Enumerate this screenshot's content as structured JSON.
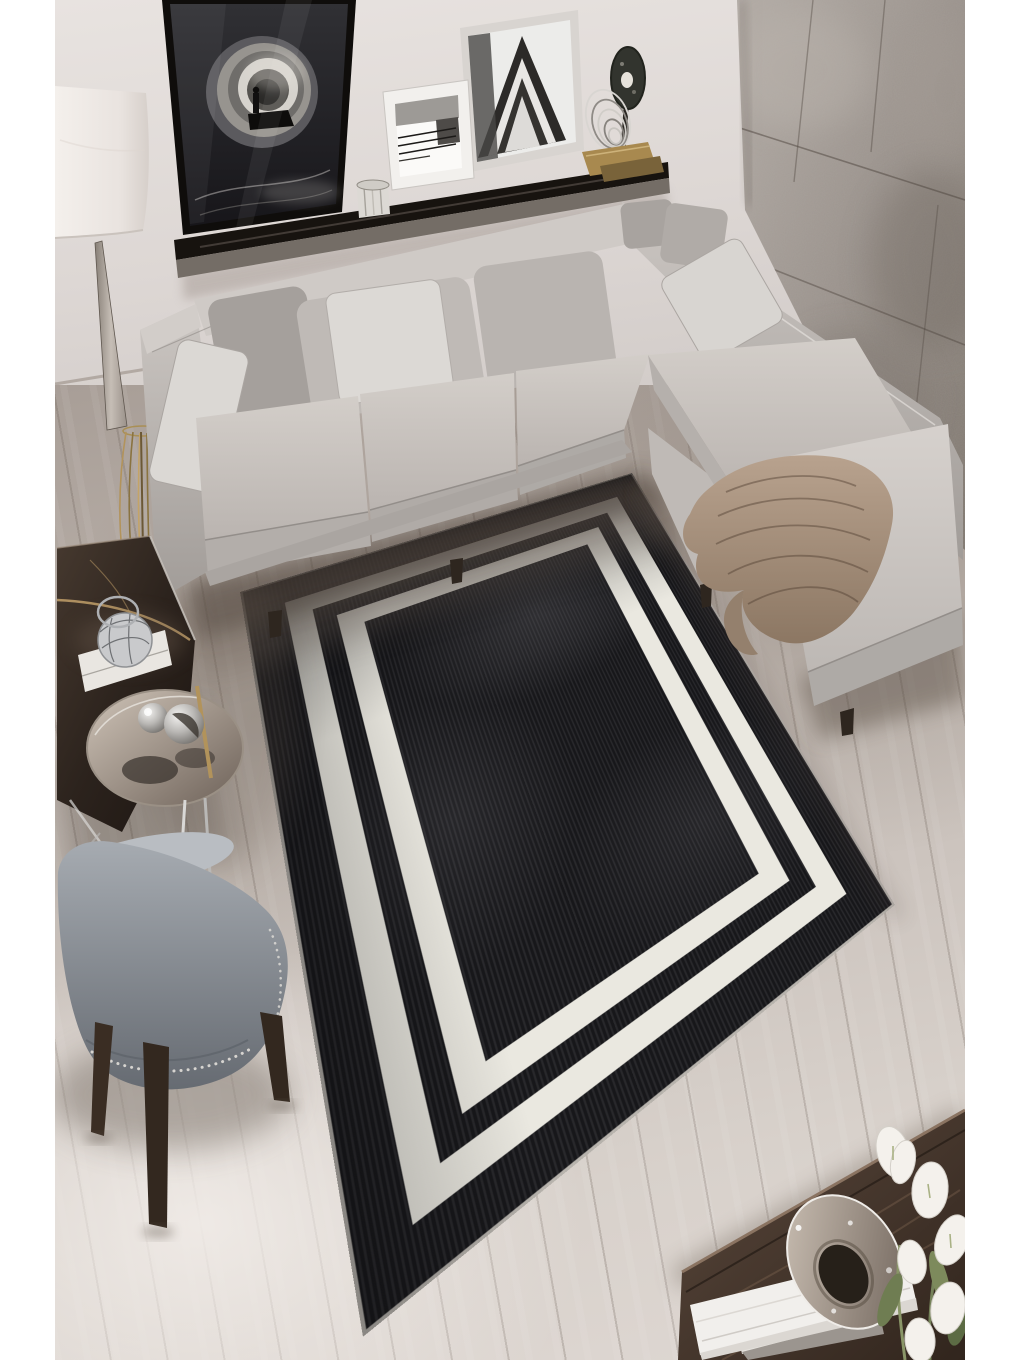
{
  "meta": {
    "alt": "Top-down lifestyle photo of a rectangular black distressed rug with a double white border frame, styled in a modern living room with a light gray L-shaped sectional sofa, concrete panel accent wall, black wall ledge with black-and-white framed art, sculptural floor lamp, dark marble coffee table with silver decor, gray wingback chair with nailhead trim, and a dark wood table with white lilies and books on a pale wood floor. White margins on left and right sides."
  },
  "palette": {
    "margin_white": "#ffffff",
    "wall": "#e8e3e0",
    "wall_lower": "#d0cac7",
    "concrete_light": "#b3aca6",
    "concrete_mid": "#968e88",
    "concrete_dark": "#7f776f",
    "floor_light": "#ded7d2",
    "floor_mid": "#ccc4be",
    "floor_dark": "#a89e97",
    "sofa_light": "#d3cec9",
    "sofa_mid": "#bcb7b3",
    "sofa_dark": "#a19c98",
    "pillow_white": "#dcd9d5",
    "rug_black": "#17171a",
    "rug_white": "#eae8e0",
    "shelf_dark": "#17130f",
    "blanket_tan": "#ab9480",
    "chair_gray": "#8f949b",
    "chair_leg_wood": "#3a2d23",
    "marble_dark": "#352c26",
    "marble_vein_gold": "#c2a06a",
    "chrome": "#d9d8d6",
    "brass": "#b2935b",
    "wood_table_brown": "#4a3a30",
    "leaf_green": "#76835a",
    "flower_white": "#f4f1ec",
    "lamp_shade": "#efeae6"
  },
  "scene": {
    "objects": [
      "black-rug-double-white-border",
      "gray-sectional-sofa",
      "throw-blanket",
      "concrete-accent-wall",
      "wall-ledge-shelf",
      "tunnel-artwork",
      "chevron-artwork",
      "lines-artwork",
      "disc-sculpture",
      "crystal-votive",
      "floor-lamp",
      "marble-coffee-table",
      "round-side-table",
      "silver-spheres",
      "lattice-sculpture",
      "gray-wingback-chair",
      "dark-wood-table",
      "white-books",
      "crystal-ring-ornament",
      "white-lilies",
      "pale-wood-floor"
    ]
  },
  "rug_product": {
    "field": "distressed black",
    "pattern": "two nested white rectangular border bands"
  }
}
